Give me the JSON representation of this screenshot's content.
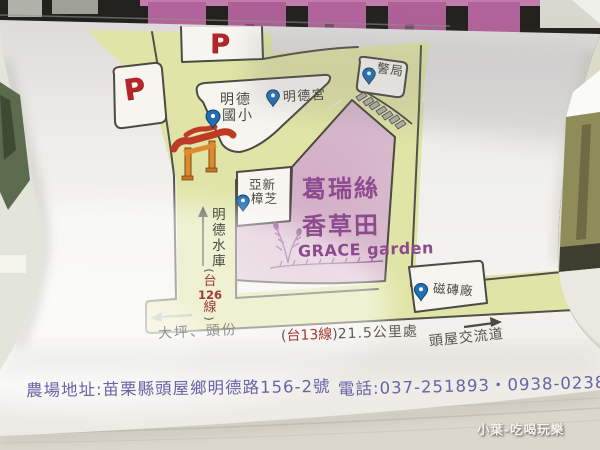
{
  "scene": {
    "watermark": "小葉-吃喝玩樂"
  },
  "map": {
    "p_top": "P",
    "p_left": "P",
    "school1": "明德",
    "school2": "國小",
    "temple": "明德宮",
    "police": "警局",
    "yaxin1": "亞新",
    "yaxin2": "樟芝",
    "tile": "磁磚廠",
    "reservoir": "明德水庫",
    "r126_open": "(",
    "r126_tai": "台",
    "r126_num": "126",
    "r126_xian": "線",
    "r126_close": ")",
    "dapin": "大坪、頭份",
    "r13_open": "(",
    "r13_name": "台13線",
    "r13_close": ")",
    "distance": "21.5公里處",
    "interchange": "頭屋交流道",
    "garden1": "葛瑞絲",
    "garden2": "香草田",
    "garden_en": "GRACE garden"
  },
  "footer": {
    "address": "農場地址:苗栗縣頭屋鄉明德路156-2號",
    "phone": "電話:037-251893・0938-023837"
  },
  "colors": {
    "road_yellow": "#e0e4a6",
    "land_pink": "#d6b6ca",
    "garden_purple": "#8d4a8e",
    "ink_purple": "#6b62a8",
    "pin_blue": "#2170b5",
    "parking_red": "#b7252b",
    "gate_red": "#bf3a26",
    "gate_orange": "#df8a2e"
  }
}
